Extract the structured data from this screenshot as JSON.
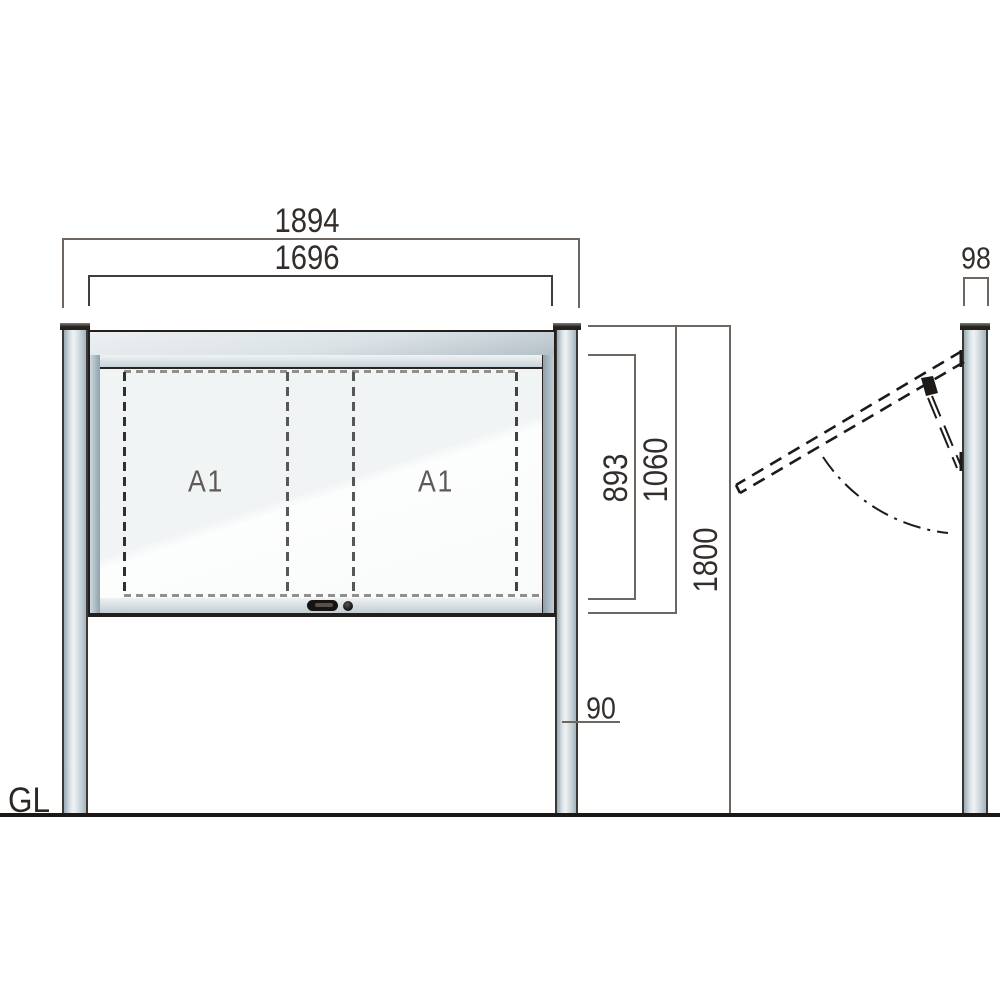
{
  "labels": {
    "outer_width": "1894",
    "opening_width": "1696",
    "opening_height": "893",
    "board_height": "1060",
    "total_height": "1800",
    "post_width": "90",
    "side_depth": "98",
    "ground_line": "GL",
    "panel_left": "A1",
    "panel_right": "A1"
  },
  "colors": {
    "outline": "#231f1c",
    "dimension_line": "#6e6661",
    "dimension_text": "#332e2b",
    "metal_light": "#eef2f4",
    "metal_mid": "#c9d3d9",
    "metal_dark": "#8fa1ab",
    "glass": "#f4f7f7",
    "poster_dash": "#8f8f8f",
    "ground": "#1c1713"
  }
}
